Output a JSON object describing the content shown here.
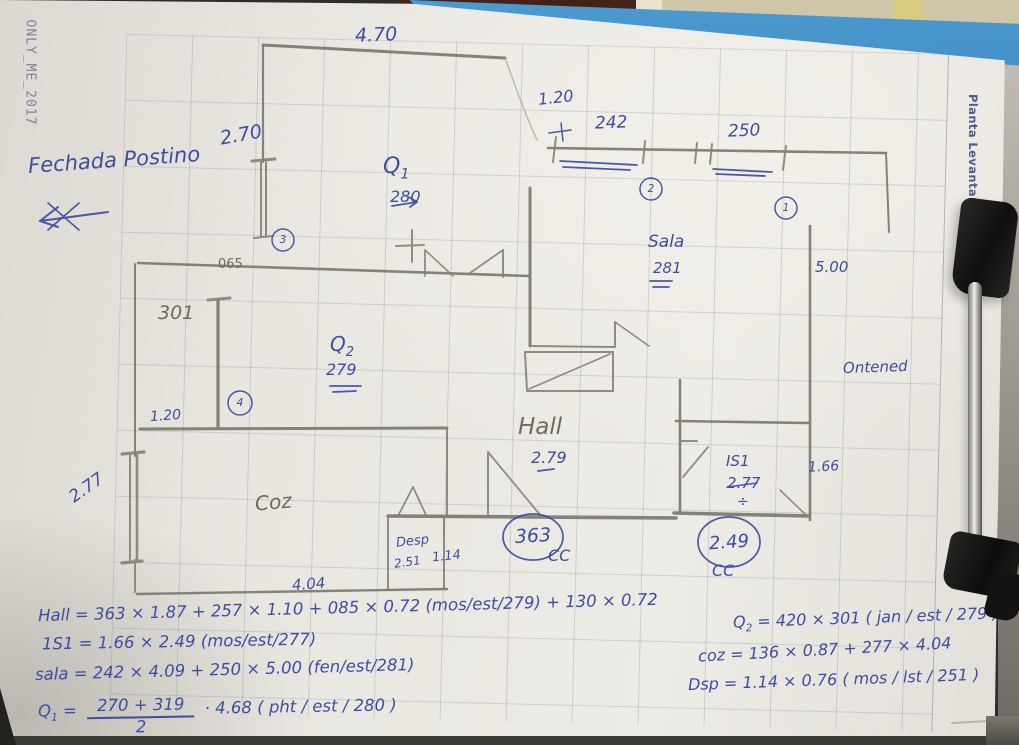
{
  "photo": {
    "watermark": "ONLY_ME_2017",
    "margin_label": "Planta Levantamento"
  },
  "notes": {
    "facade_title": "Fechada Postino"
  },
  "rooms": {
    "q1": {
      "name": "Q",
      "sub": "1",
      "height": "280"
    },
    "q2": {
      "name": "Q",
      "sub": "2",
      "height": "279"
    },
    "sala": {
      "name": "Sala",
      "height": "281"
    },
    "hall": {
      "name": "Hall",
      "height": "2.79"
    },
    "is1": {
      "name": "IS1",
      "height": "2.77",
      "divide": "÷"
    },
    "coz": {
      "name": "Coz"
    },
    "desp": {
      "name": "Desp",
      "height": "2.51"
    },
    "yard": {
      "name": "Ontened"
    }
  },
  "dimensions": {
    "top_width": "4.70",
    "left_upper_wall": "2.70",
    "top_right_opening": "1.20",
    "window2_width": "242",
    "window1_width": "250",
    "wall_065": "065",
    "wall_301": "301",
    "left_opening": "1.20",
    "right_wall": "5.00",
    "is1_width": "1.66",
    "left_window": "2.77",
    "bottom_width": "4.04",
    "desp_door": "1.14",
    "cc_left_value": "363",
    "cc_right_value": "2.49",
    "cc_label_left": "CC",
    "cc_label_right": "CC"
  },
  "markers": {
    "m1": "1",
    "m2": "2",
    "m3": "3",
    "m4": "4"
  },
  "formulas": {
    "hall": "Hall = 363 × 1.87 + 257 × 1.10 + 085 × 0.72 (mos/est/279) + 130 × 0.72",
    "is1": "1S1 = 1.66 × 2.49 (mos/est/277)",
    "sala": "sala = 242 × 4.09 + 250 × 5.00 (fen/est/281)",
    "q1_lhs": "Q",
    "q1_sub": "1",
    "q1_eq": "=",
    "q1_num": "270 + 319",
    "q1_den": "2",
    "q1_tail": "· 4.68 ( pht / est / 280 )",
    "q2_lhs": "Q",
    "q2_sub": "2",
    "q2_rest": "= 420 × 301 ( jan / est / 279 )",
    "coz": "coz = 136 × 0.87 + 277 × 4.04",
    "desp": "Dsp = 1.14 × 0.76 ( mos / lst / 251 )"
  }
}
